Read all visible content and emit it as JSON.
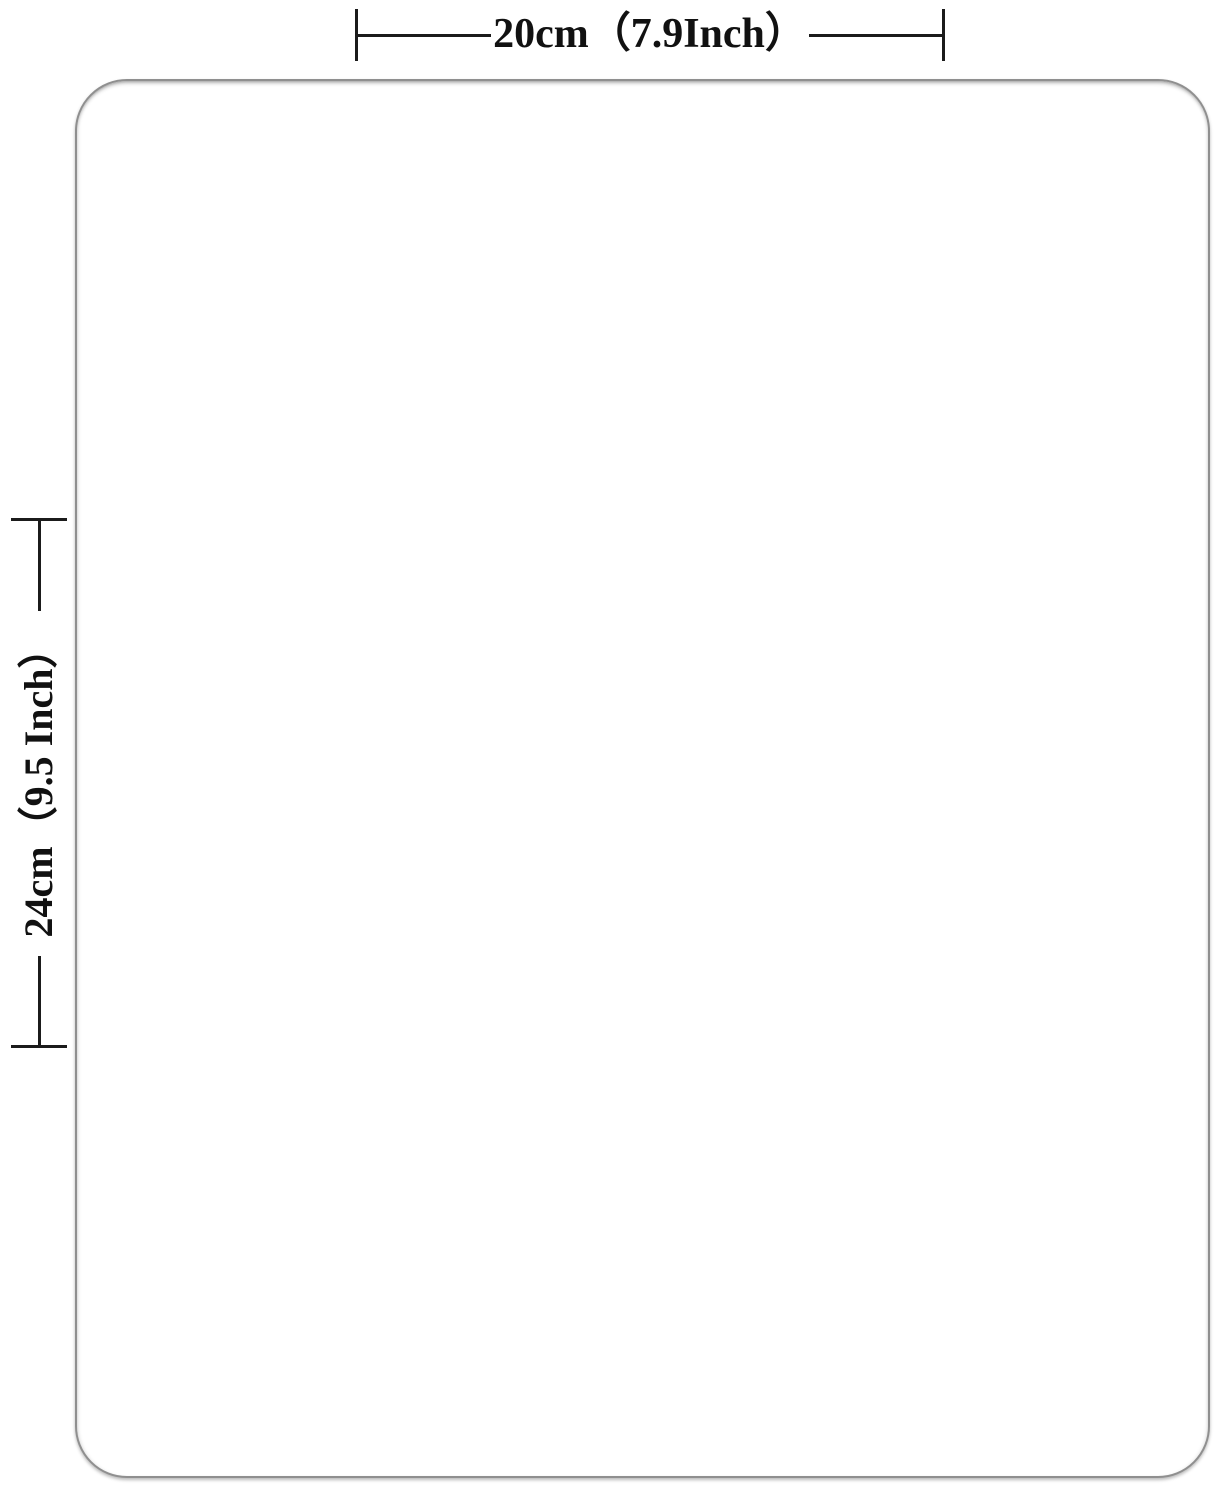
{
  "canvas": {
    "width_px": 1217,
    "height_px": 1492,
    "background_color": "#ffffff"
  },
  "product": {
    "shape": "rounded-rectangle-pad",
    "fill_color": "#ffffff",
    "border_color": "#8f8f8f"
  },
  "dimensions": {
    "line_color": "#1b1b1b",
    "text_color": "#111111",
    "width": {
      "label": "20cm（7.9Inch）"
    },
    "height": {
      "label": "24cm（9.5 Inch）"
    }
  }
}
